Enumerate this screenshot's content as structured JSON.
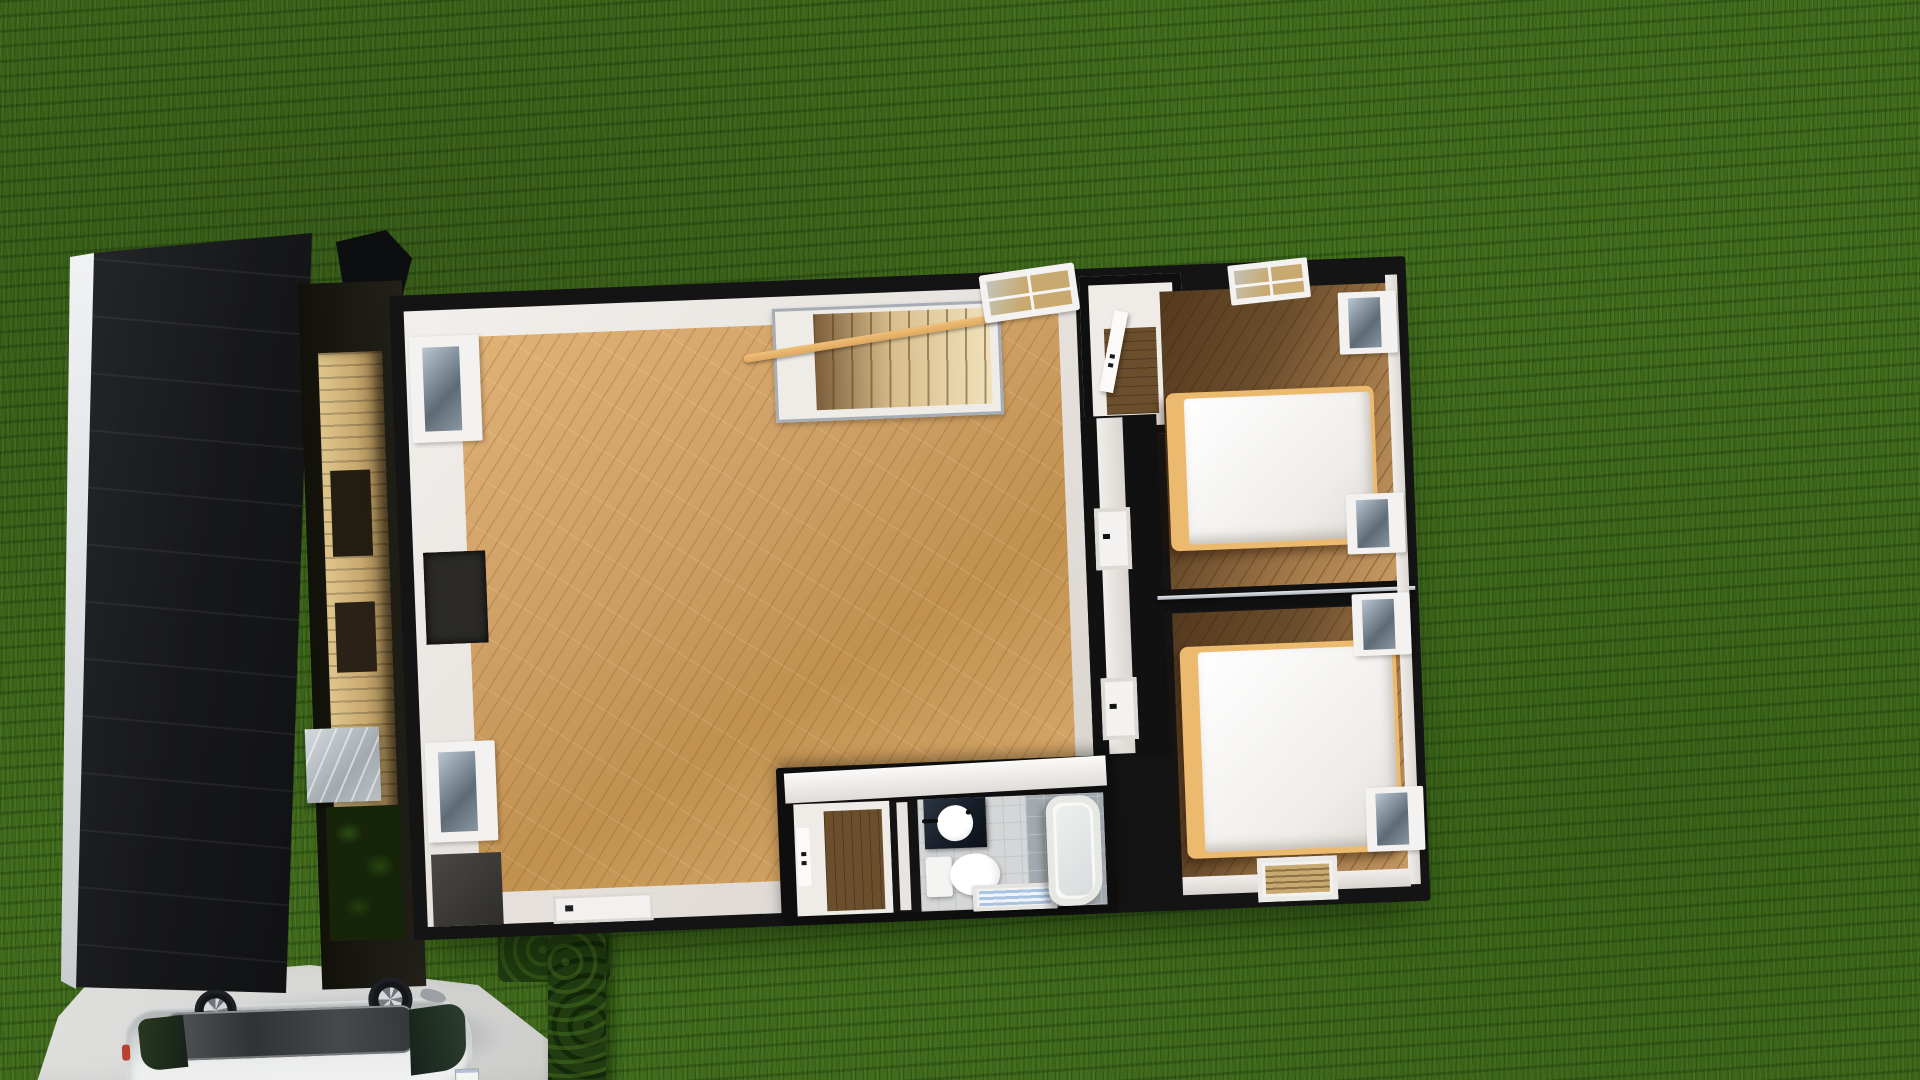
{
  "view": {
    "type": "3d-render-top-down",
    "description": "Overhead cutaway (dollhouse) render of a house upper floor surrounded by lawn, with garage roof, driveway and parked car"
  },
  "colors": {
    "grass": "#3e681b",
    "driveway": "#d6d7d5",
    "roof": "#17181a",
    "ridge": "#c9ccd0",
    "wallblack": "#141414",
    "wallwhite": "#e4dfda",
    "oak": "#cfa065",
    "oakdark": "#6b4e2c",
    "stair": "#d9bf8d",
    "handrail": "#dfa75f",
    "rail": "#a7adb5",
    "bedframe": "#ecba6e",
    "linen": "#efedea",
    "tile": "#d4d6d7",
    "marble": "#a2a9af",
    "vanity": "#161d28",
    "hedge": "#203c10",
    "carbody": "#f4f5f4",
    "carroof": "#2f3335",
    "glass": "#16221a",
    "blind": "#a9c4e0",
    "tanwall": "#c8a96f"
  },
  "scene": {
    "environment": [
      "lawn",
      "concrete-driveway",
      "hedge-row",
      "garage-roof",
      "side-passage"
    ],
    "rooms": [
      {
        "name": "living-room",
        "floor": "light-oak-diagonal-planks",
        "features": [
          "staircase-with-wood-handrail",
          "metal-stair-railing",
          "top-wall-window",
          "two-left-wall-windows",
          "wall-recess",
          "bottom-wall-door"
        ]
      },
      {
        "name": "hallway-closet",
        "features": [
          "open-white-door",
          "dark-wood-floor"
        ]
      },
      {
        "name": "bedroom-top",
        "floor": "oak-shadowed",
        "furniture": [
          "double-bed-white-duvet-wood-frame"
        ],
        "windows": [
          "top-wall-window",
          "right-wall-window-upper",
          "right-wall-window-lower"
        ]
      },
      {
        "name": "bedroom-bottom",
        "floor": "oak-shadowed",
        "furniture": [
          "double-bed-white-duvet-wood-frame"
        ],
        "windows": [
          "right-wall-window-upper",
          "right-wall-window-lower",
          "bottom-wall-window-with-blinds"
        ]
      },
      {
        "name": "bathroom",
        "floor": "grey-tile-and-marble",
        "fixtures": [
          "dark-vanity-round-sink",
          "toilet",
          "freestanding-bathtub",
          "window-with-blue-blinds"
        ]
      },
      {
        "name": "bathroom-hall",
        "features": [
          "white-door-with-handle",
          "dark-wood-floor"
        ]
      }
    ],
    "vehicle": {
      "name": "silver-car",
      "parts": [
        "body",
        "dark-roof",
        "windshield",
        "rear-window",
        "two-wheels",
        "side-mirror",
        "license-plate",
        "taillight"
      ]
    }
  }
}
